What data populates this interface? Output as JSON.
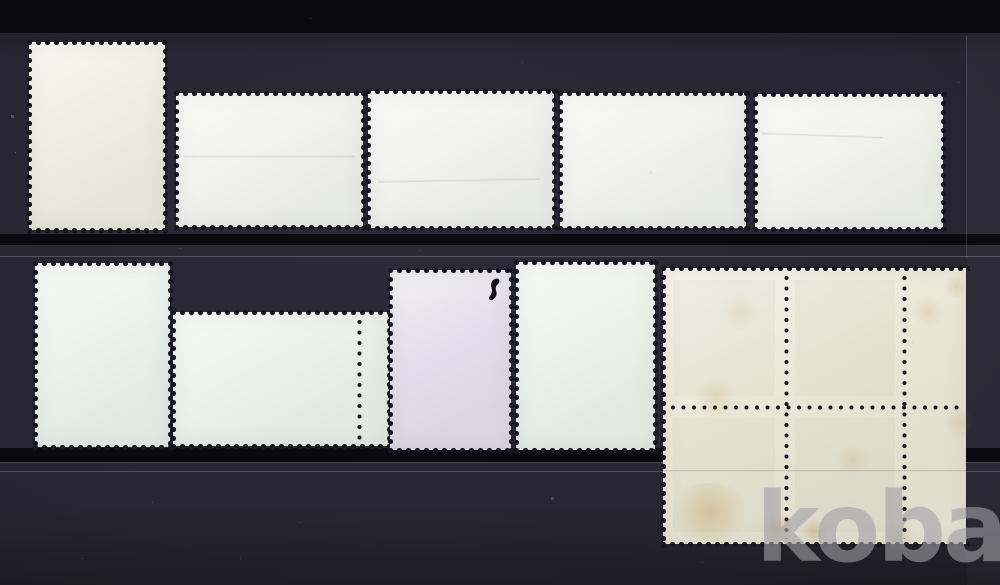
{
  "photo": {
    "subject": "Eleven postage stamps photographed from the back (gum side) on a dark stockbook page",
    "rows": 2,
    "item_count": 10,
    "watermark": {
      "text": "kobay"
    }
  },
  "colors": {
    "bg": "#24222f",
    "strip": "#0b0a10",
    "hole": "#17151f",
    "cream": "#efeee1",
    "white": "#f2f3ef",
    "white2": "#eef1ec",
    "green": "#edf1ea",
    "lilac": "#e3dfec",
    "blockcream": "#eae7d6",
    "wm": "rgba(161,160,169,0.6)"
  },
  "items": [
    {
      "id": "stamp-1",
      "type": "single stamp back",
      "orientation": "portrait",
      "paper": "cream"
    },
    {
      "id": "stamp-2",
      "type": "single stamp back",
      "orientation": "landscape",
      "paper": "white"
    },
    {
      "id": "stamp-3",
      "type": "single stamp back",
      "orientation": "landscape",
      "paper": "white"
    },
    {
      "id": "stamp-4",
      "type": "single stamp back",
      "orientation": "landscape",
      "paper": "white"
    },
    {
      "id": "stamp-5",
      "type": "single stamp back",
      "orientation": "landscape",
      "paper": "white"
    },
    {
      "id": "stamp-6",
      "type": "single stamp back",
      "orientation": "portrait",
      "paper": "white"
    },
    {
      "id": "stamp-7",
      "type": "single stamp back with perforated sheet margin",
      "orientation": "landscape",
      "paper": "white"
    },
    {
      "id": "stamp-8",
      "type": "single stamp back with black pen squiggle",
      "orientation": "portrait",
      "paper": "lilac"
    },
    {
      "id": "stamp-9",
      "type": "single stamp back",
      "orientation": "portrait",
      "paper": "white"
    },
    {
      "id": "stamp-block",
      "type": "block of stamps with right selvage, toned",
      "rows": 2,
      "cols": 3,
      "paper": "toned cream"
    }
  ]
}
